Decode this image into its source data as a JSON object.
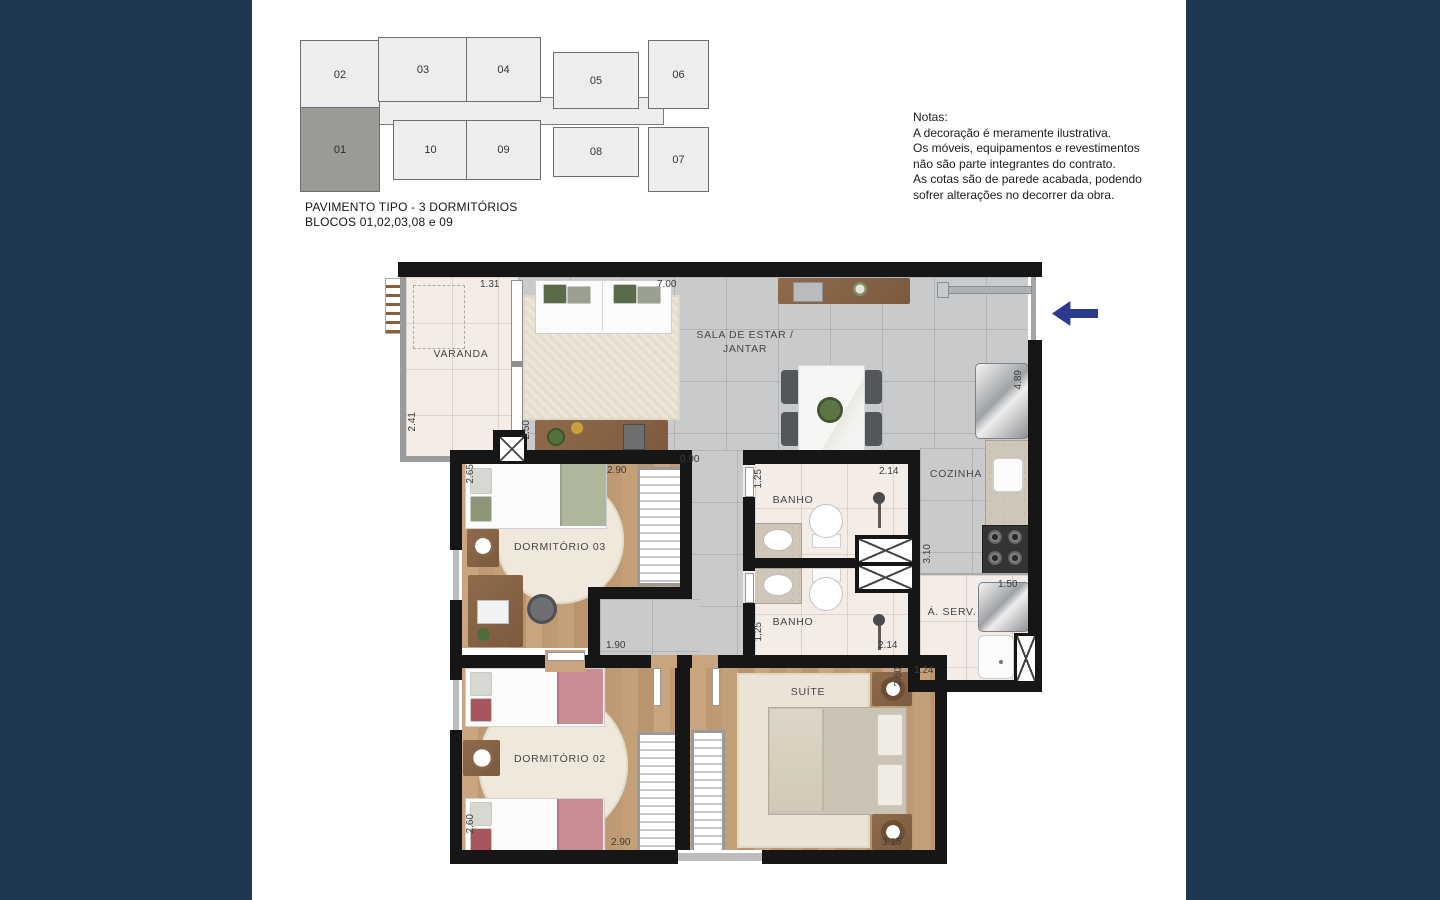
{
  "key_plan": {
    "caption_line1": "PAVIMENTO TIPO - 3 DORMITÓRIOS",
    "caption_line2": "BLOCOS 01,02,03,08 e 09",
    "units": [
      {
        "label": "02",
        "selected": false
      },
      {
        "label": "03",
        "selected": false
      },
      {
        "label": "04",
        "selected": false
      },
      {
        "label": "05",
        "selected": false
      },
      {
        "label": "06",
        "selected": false
      },
      {
        "label": "01",
        "selected": true
      },
      {
        "label": "10",
        "selected": false
      },
      {
        "label": "09",
        "selected": false
      },
      {
        "label": "08",
        "selected": false
      },
      {
        "label": "07",
        "selected": false
      }
    ],
    "selected_unit": "01"
  },
  "notes": {
    "title": "Notas:",
    "line1": "A decoração é meramente ilustrativa.",
    "line2": "Os móveis, equipamentos e revestimentos",
    "line3": "não são parte integrantes do contrato.",
    "line4": "As cotas são de parede acabada, podendo",
    "line5": "sofrer alterações no decorrer da obra."
  },
  "floor_plan": {
    "rooms": {
      "varanda": "VARANDA",
      "sala_line1": "SALA DE ESTAR /",
      "sala_line2": "JANTAR",
      "cozinha": "COZINHA",
      "banho1": "BANHO",
      "banho2": "BANHO",
      "area_servico": "Á. SERV.",
      "dormitorio3": "DORMITÓRIO 03",
      "dormitorio2": "DORMITÓRIO 02",
      "suite": "SUÍTE"
    },
    "dimensions": [
      {
        "value": "1.31"
      },
      {
        "value": "7.00"
      },
      {
        "value": "2.41"
      },
      {
        "value": "2.50"
      },
      {
        "value": "0.90"
      },
      {
        "value": "2.90"
      },
      {
        "value": "2.65"
      },
      {
        "value": "1.90"
      },
      {
        "value": "1.25"
      },
      {
        "value": "2.14"
      },
      {
        "value": "1.25"
      },
      {
        "value": "2.14"
      },
      {
        "value": "4.89"
      },
      {
        "value": "3.10"
      },
      {
        "value": "1.50"
      },
      {
        "value": "1.24"
      },
      {
        "value": "2.60"
      },
      {
        "value": "2.90"
      },
      {
        "value": "2.60"
      },
      {
        "value": "3.15"
      }
    ]
  },
  "colors": {
    "background_navy": "#1D384F",
    "arrow_blue": "#2B3A8C",
    "selected_unit_gray": "#9A9B97",
    "wall_black": "#161616"
  }
}
